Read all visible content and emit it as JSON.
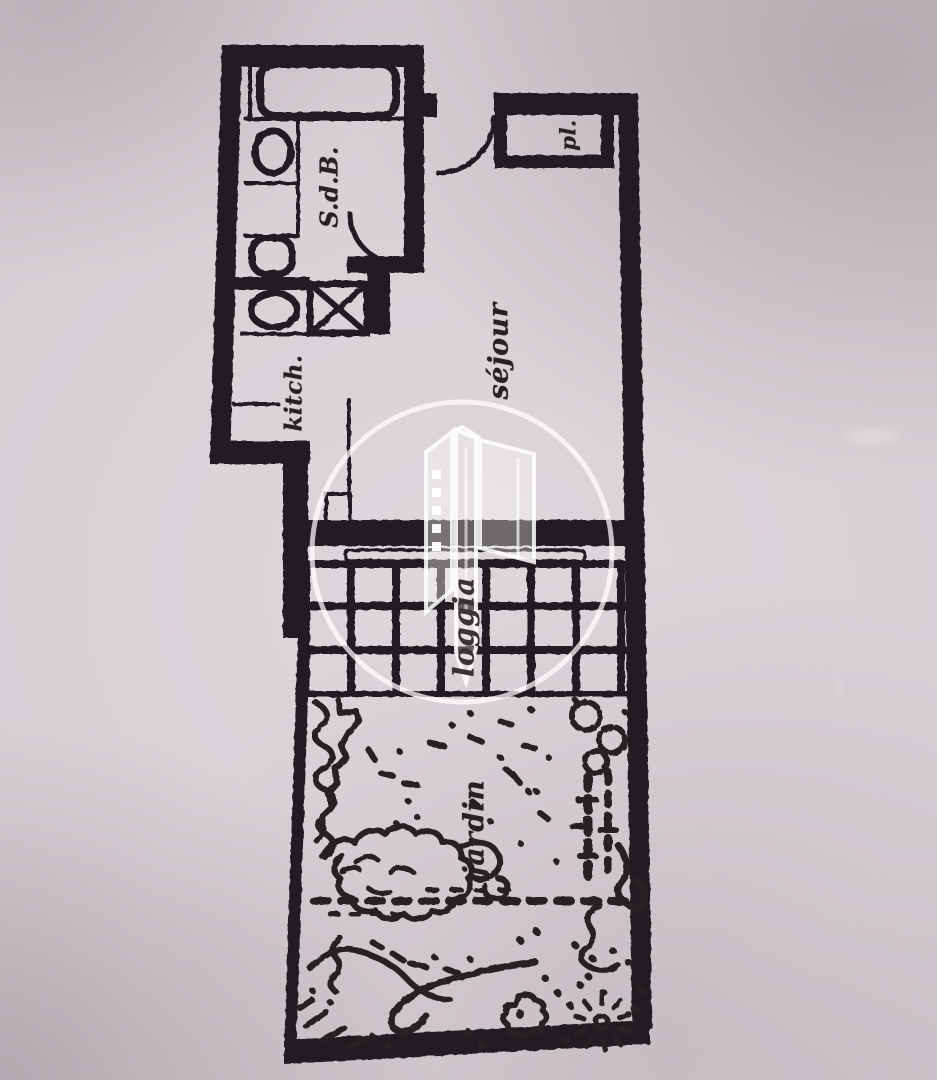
{
  "document": {
    "kind": "scanned floor plan photograph",
    "language": "fr"
  },
  "rooms": {
    "sdb": {
      "label": "S.d.B."
    },
    "pl": {
      "label": "pl."
    },
    "kitch": {
      "label": "kitch."
    },
    "sejour": {
      "label": "séjour"
    },
    "loggia": {
      "label": "loggia"
    },
    "jardin": {
      "label": "jardin"
    }
  },
  "fixtures": [
    "bathtub",
    "washbasin",
    "toilet",
    "laundry-oval",
    "appliance-crossed-box",
    "entry-door-arc",
    "bathroom-door-arc",
    "loggia-tile-grid",
    "loggia-window-bar",
    "garden-dotted-path",
    "garden-shrubs",
    "garden-flowers",
    "garden-hedge"
  ],
  "watermark": {
    "shape": "circle",
    "icon": "building-towers-logo"
  },
  "colors": {
    "ink": "#241f21",
    "paper_center": "#dcd5da",
    "paper_edge": "#a1949b",
    "watermark": "rgba(255,255,255,0.8)"
  }
}
